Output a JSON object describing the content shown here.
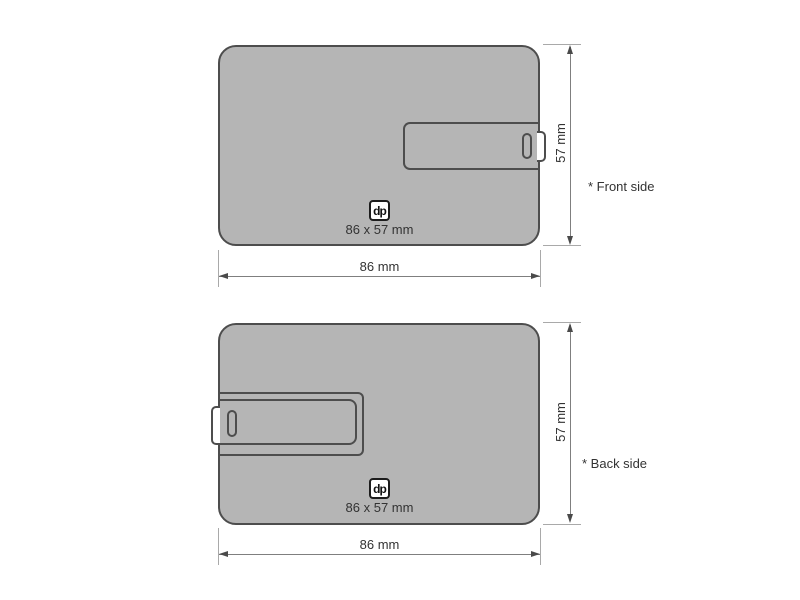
{
  "colors": {
    "card_fill": "#b5b5b5",
    "card_outline": "#4d4d4d",
    "connector_fill": "#ffffff",
    "logo_border": "#1c1c1c",
    "dim_line": "#7f7f7f",
    "ext_line": "#a9a9a9",
    "arrow": "#4a4a4a",
    "text": "#333333"
  },
  "front": {
    "side_label": "* Front side",
    "width_label": "86 mm",
    "height_label": "57 mm",
    "logo_text": "dp",
    "size_caption": "86 x 57 mm"
  },
  "back": {
    "side_label": "* Back side",
    "width_label": "86 mm",
    "height_label": "57 mm",
    "logo_text": "dp",
    "size_caption": "86 x 57 mm"
  }
}
